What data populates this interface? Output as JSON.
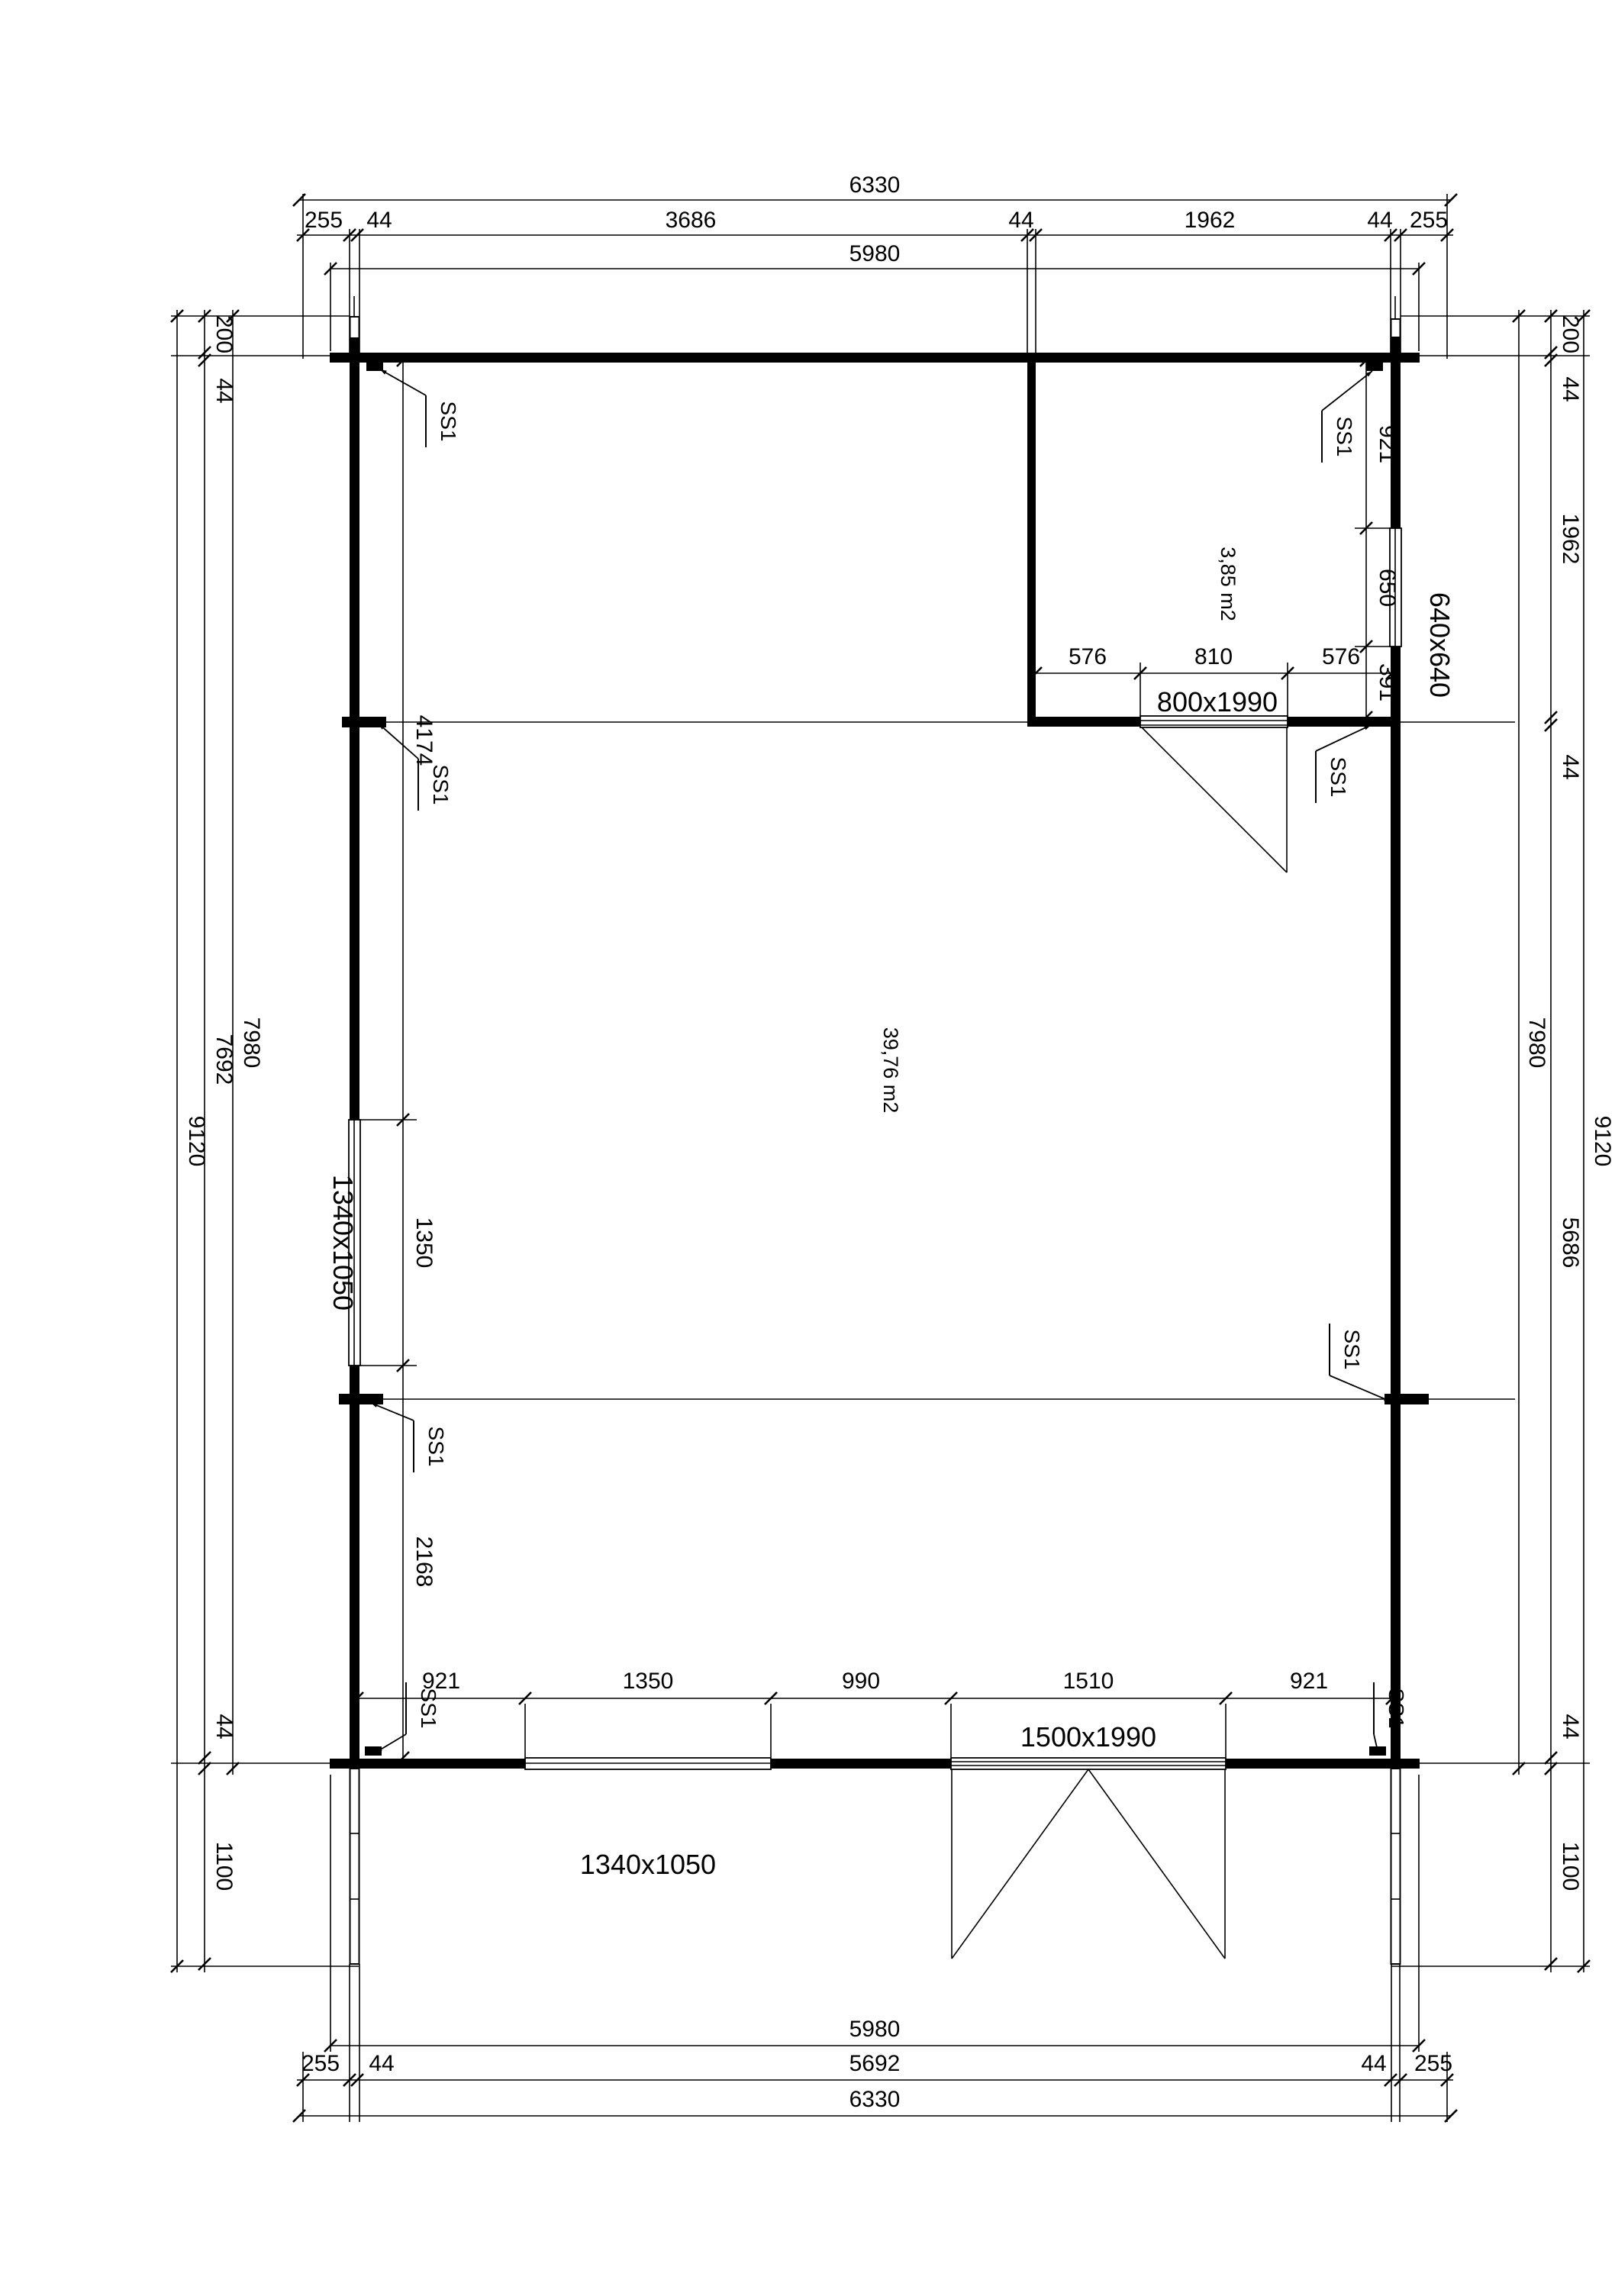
{
  "sheet": {
    "background": "#ffffff",
    "line_color": "#000000"
  },
  "rooms": [
    {
      "name": "main-room",
      "area_label": "39,76 m2"
    },
    {
      "name": "small-room",
      "area_label": "3,85 m2"
    }
  ],
  "openings": {
    "interior_door": "800x1990",
    "right_window": "640x640",
    "left_window": "1340x1050",
    "bottom_window": "1340x1050",
    "front_door": "1500x1990"
  },
  "marker": "SS1",
  "dims": {
    "top": {
      "total": "6330",
      "chain": [
        "255",
        "44",
        "3686",
        "44",
        "1962",
        "44",
        "255"
      ],
      "inner": "5980"
    },
    "bottom": {
      "inner": "5980",
      "chain": [
        "255",
        "44",
        "5692",
        "44",
        "255"
      ],
      "total": "6330"
    },
    "left": {
      "chain": [
        "200",
        "44",
        "7692",
        "44",
        "1100"
      ],
      "wall": "7980",
      "total": "9120"
    },
    "right": {
      "chain": [
        "200",
        "44",
        "1962",
        "44",
        "5686",
        "44",
        "1100"
      ],
      "wall": "7980",
      "total": "9120"
    },
    "interior_left": [
      "4174",
      "1350",
      "2168"
    ],
    "small_room_right": [
      "921",
      "650",
      "391"
    ],
    "small_room_top": [
      "576",
      "810",
      "576"
    ],
    "bottom_interior": [
      "921",
      "1350",
      "990",
      "1510",
      "921"
    ]
  }
}
